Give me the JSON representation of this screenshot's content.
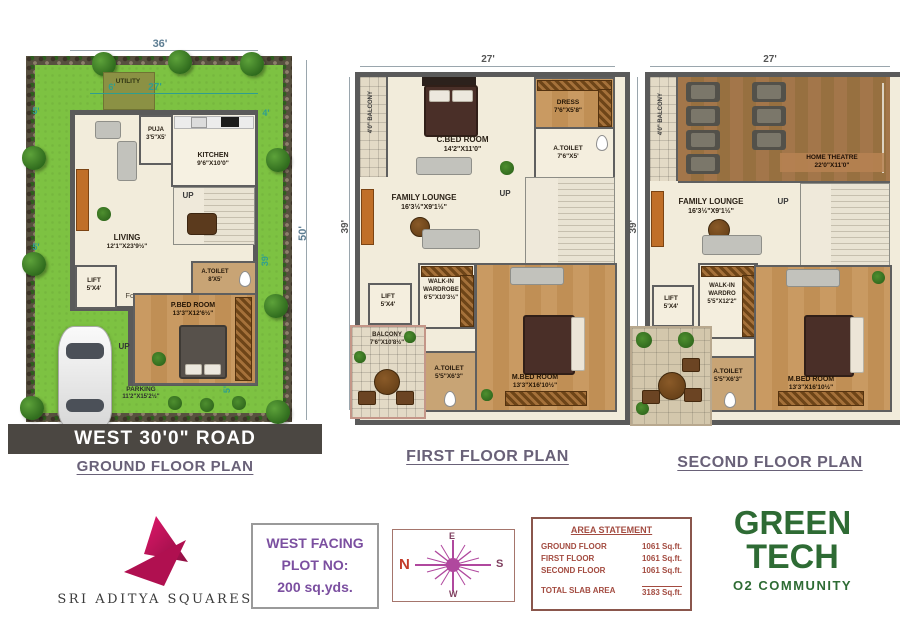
{
  "colors": {
    "accent_teal": "#2f9e8f",
    "title_purple": "#696178",
    "area_maroon": "#a34b40",
    "plot_purple": "#7b4fa0",
    "green_logo": "#2e6b34",
    "brand_pink": "#c21858",
    "road_gray": "#4b4742"
  },
  "ground": {
    "title": "GROUND FLOOR PLAN",
    "road": "WEST 30'0\"  ROAD",
    "dims": {
      "top": "36'",
      "inner": "27'",
      "utility_width": "6'",
      "left_upper": "5'",
      "left_lower": "5'",
      "right_top": "4'",
      "side_inner": "39'",
      "side_total": "50'",
      "bottom": "5'"
    },
    "rooms": {
      "utility": {
        "label": "UTILITY"
      },
      "puja": {
        "label": "PUJA",
        "size": "3'5\"X5'"
      },
      "kitchen": {
        "label": "KITCHEN",
        "size": "9'6\"X10'0\""
      },
      "living": {
        "label": "LIVING",
        "size": "12'1\"X23'9½\""
      },
      "lift": {
        "label": "LIFT",
        "size": "5'X4'"
      },
      "foyer": {
        "label": "Foyer"
      },
      "toilet": {
        "label": "A.TOILET",
        "size": "8'X5'"
      },
      "bedroom": {
        "label": "P.BED ROOM",
        "size": "13'3\"X12'6½\""
      },
      "parking": {
        "label": "PARKING",
        "size": "11'2\"X15'2½\""
      },
      "up_stairs": {
        "label": "UP"
      },
      "up_entry": {
        "label": "UP"
      }
    }
  },
  "first": {
    "title": "FIRST FLOOR PLAN",
    "dims": {
      "top": "27'",
      "left": "39'"
    },
    "rooms": {
      "balcony_side": {
        "label": "4'0\" BALCONY"
      },
      "cbed": {
        "label": "C.BED ROOM",
        "size": "14'2\"X11'0\""
      },
      "dress": {
        "label": "DRESS",
        "size": "7'6\"X5'8\""
      },
      "toilet_top": {
        "label": "A.TOILET",
        "size": "7'6\"X5'"
      },
      "lounge": {
        "label": "FAMILY LOUNGE",
        "size": "16'3½\"X9'1½\""
      },
      "up": {
        "label": "UP"
      },
      "lift": {
        "label": "LIFT",
        "size": "5'X4'"
      },
      "wardrobe": {
        "label": "WALK-IN WARDROBE",
        "size": "6'5\"X10'3½\""
      },
      "balcony": {
        "label": "BALCONY",
        "size": "7'6\"X10'8½\""
      },
      "toilet": {
        "label": "A.TOILET",
        "size": "5'5\"X6'3\""
      },
      "mbed": {
        "label": "M.BED ROOM",
        "size": "13'3\"X16'10½\""
      }
    }
  },
  "second": {
    "title": "SECOND FLOOR PLAN",
    "dims": {
      "top": "27'",
      "left": "39'"
    },
    "rooms": {
      "balcony_side": {
        "label": "4'0\" BALCONY"
      },
      "theatre": {
        "label": "HOME THEATRE",
        "size": "22'0\"X11'0\""
      },
      "lounge": {
        "label": "FAMILY LOUNGE",
        "size": "16'3½\"X9'1½\""
      },
      "up": {
        "label": "UP"
      },
      "lift": {
        "label": "LIFT",
        "size": "5'X4'"
      },
      "wardrobe": {
        "label": "WALK-IN WARDRO",
        "size": "5'5\"X12'2\""
      },
      "toilet": {
        "label": "A.TOILET",
        "size": "5'5\"X6'3\""
      },
      "mbed": {
        "label": "M.BED ROOM",
        "size": "13'3\"X16'10½\""
      }
    }
  },
  "footer": {
    "brand": {
      "name": "SRI ADITYA SQUARES"
    },
    "plot": {
      "line1": "WEST FACING",
      "line2": "PLOT NO:",
      "line3": "200 sq.yds."
    },
    "compass": {
      "n": "N",
      "e": "E",
      "s": "S",
      "w": "W"
    },
    "area": {
      "title": "AREA STATEMENT",
      "rows": [
        {
          "label": "GROUND FLOOR",
          "value": "1061 Sq.ft."
        },
        {
          "label": "FIRST FLOOR",
          "value": "1061 Sq.ft."
        },
        {
          "label": "SECOND FLOOR",
          "value": "1061 Sq.ft."
        }
      ],
      "total_label": "TOTAL SLAB AREA",
      "total_value": "3183 Sq.ft."
    },
    "community": {
      "line1": "GREEN",
      "line2": "TECH",
      "line3": "O2 COMMUNITY"
    }
  }
}
